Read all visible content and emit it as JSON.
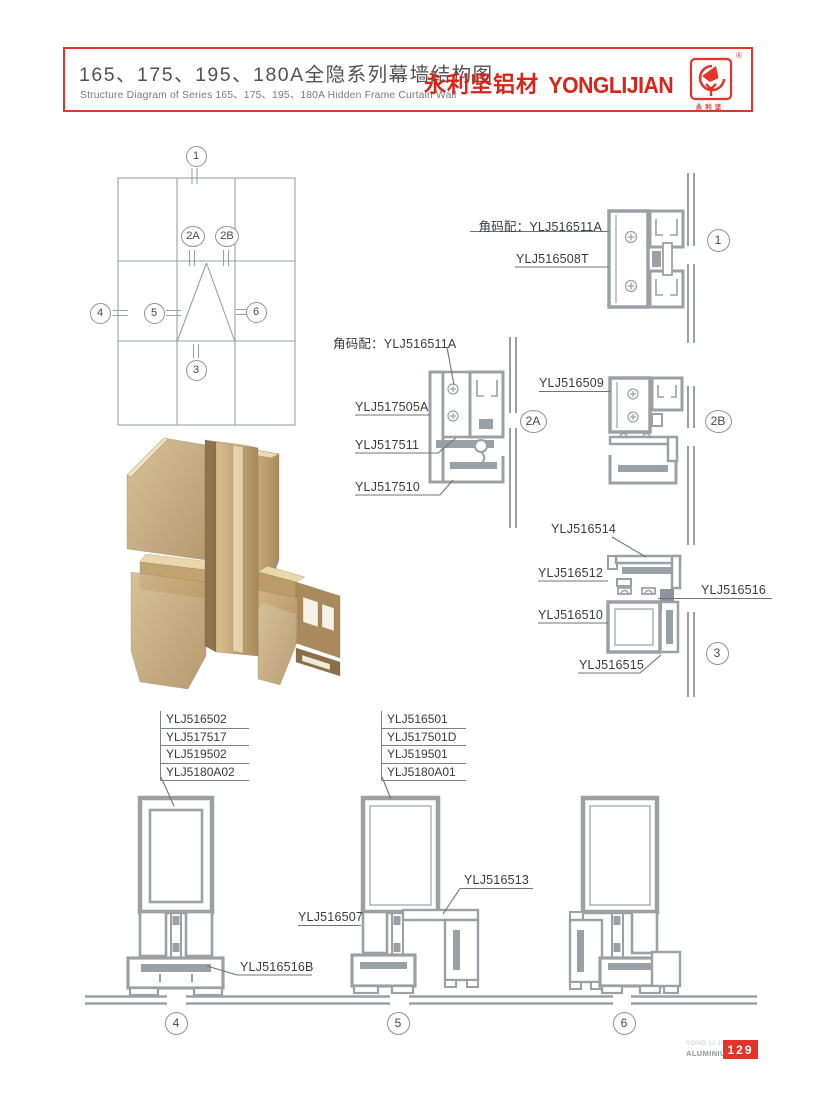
{
  "header": {
    "title_cn": "165、175、195、180A全隐系列幕墙结构图",
    "subtitle_en": "Structure Diagram of Series 165、175、195、180A Hidden Frame Curtain Wall",
    "brand_cn": "永利坚铝材",
    "brand_en": "YONGLIJIAN",
    "registered": "®",
    "logo_caption": "永利坚",
    "border_color": "#e5332a",
    "brand_color": "#da2417"
  },
  "markers": {
    "e1": "1",
    "e2a": "2A",
    "e2b": "2B",
    "e4": "4",
    "e5": "5",
    "e6": "6",
    "e3": "3",
    "d1": "1",
    "d2a": "2A",
    "d2b": "2B",
    "d3": "3",
    "d4": "4",
    "d5": "5",
    "d6": "6"
  },
  "labels": {
    "d1_corner": "角码配：YLJ516511A",
    "d1_part1": "YLJ516508T",
    "d2a_corner": "角码配：YLJ516511A",
    "d2a_part1": "YLJ517505A",
    "d2a_part2": "YLJ517511",
    "d2a_part3": "YLJ517510",
    "d2b_part1": "YLJ516509",
    "d3_part1": "YLJ516514",
    "d3_part2": "YLJ516512",
    "d3_part3": "YLJ516516",
    "d3_part4": "YLJ516510",
    "d3_part5": "YLJ516515",
    "d4_stack": [
      "YLJ516502",
      "YLJ517517",
      "YLJ519502",
      "YLJ5180A02"
    ],
    "d4_part1": "YLJ516516B",
    "d5_stack": [
      "YLJ516501",
      "YLJ517501D",
      "YLJ519501",
      "YLJ5180A01"
    ],
    "d5_part1": "YLJ516507",
    "d5_part2": "YLJ516513"
  },
  "footer": {
    "company_line1": "YONG LI JIAN",
    "company_line2": "ALUMINIUM",
    "page_number": "129",
    "badge_color": "#e5332a"
  },
  "colors": {
    "line_gray": "#9ba0a5",
    "solid_gray": "#99a0a6",
    "leader": "#6f7377",
    "text_dark": "#3a3b3d",
    "bronze": "#b7986a"
  }
}
